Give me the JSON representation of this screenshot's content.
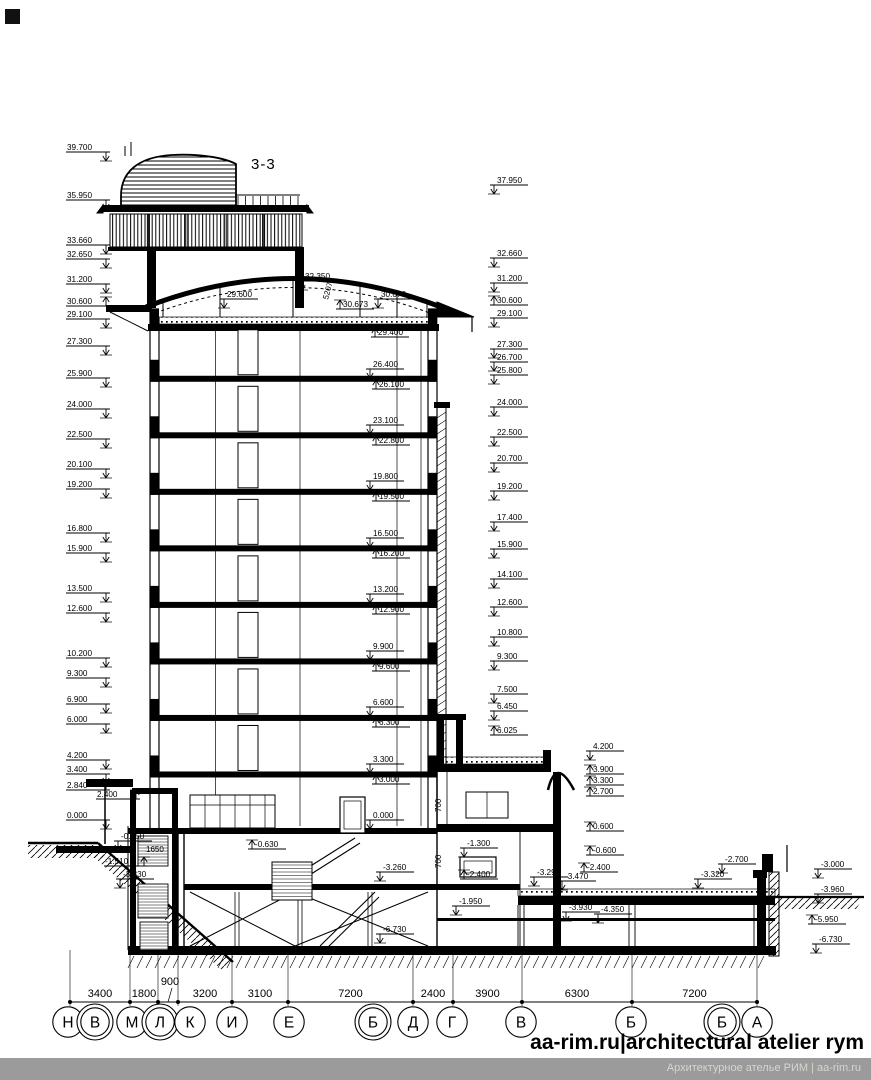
{
  "title": "3-3",
  "footer": {
    "brand": "aa-rim.ru|architectural atelier rym",
    "bar_text": "Архитектурное ателье РИМ | aa-rim.ru"
  },
  "colors": {
    "ink": "#000000",
    "footer_bar": "#9b9b9b",
    "footer_text": "#d8d5cf"
  },
  "levels": {
    "left": [
      {
        "v": "39.700",
        "y": 152,
        "d": "dn"
      },
      {
        "v": "35.950",
        "y": 200,
        "d": "dn"
      },
      {
        "v": "33.660",
        "y": 245,
        "d": "dn"
      },
      {
        "v": "32.650",
        "y": 259,
        "d": "dn"
      },
      {
        "v": "31.200",
        "y": 284,
        "d": "dn"
      },
      {
        "v": "30.600",
        "y": 306,
        "d": "up"
      },
      {
        "v": "29.100",
        "y": 319,
        "d": "dn"
      },
      {
        "v": "27.300",
        "y": 346,
        "d": "dn"
      },
      {
        "v": "25.900",
        "y": 378,
        "d": "dn"
      },
      {
        "v": "24.000",
        "y": 409,
        "d": "dn"
      },
      {
        "v": "22.500",
        "y": 439,
        "d": "dn"
      },
      {
        "v": "20.100",
        "y": 469,
        "d": "dn"
      },
      {
        "v": "19.200",
        "y": 489,
        "d": "dn"
      },
      {
        "v": "16.800",
        "y": 533,
        "d": "dn"
      },
      {
        "v": "15.900",
        "y": 553,
        "d": "dn"
      },
      {
        "v": "13.500",
        "y": 593,
        "d": "dn"
      },
      {
        "v": "12.600",
        "y": 613,
        "d": "dn"
      },
      {
        "v": "10.200",
        "y": 658,
        "d": "dn"
      },
      {
        "v": "9.300",
        "y": 678,
        "d": "dn"
      },
      {
        "v": "6.900",
        "y": 704,
        "d": "dn"
      },
      {
        "v": "6.000",
        "y": 724,
        "d": "dn"
      },
      {
        "v": "4.200",
        "y": 760,
        "d": "dn"
      },
      {
        "v": "3.400",
        "y": 774,
        "d": "dn"
      },
      {
        "v": "2.840",
        "y": 790,
        "d": "up"
      },
      {
        "v": "2.400",
        "y": 799,
        "d": "up",
        "x": 96
      },
      {
        "v": "0.000",
        "y": 820,
        "d": "dn"
      },
      {
        "v": "-1.510",
        "y": 866,
        "d": "up",
        "x": 104
      }
    ],
    "right": [
      {
        "v": "37.950",
        "y": 185,
        "d": "dn"
      },
      {
        "v": "32.660",
        "y": 258,
        "d": "dn"
      },
      {
        "v": "31.200",
        "y": 283,
        "d": "dn"
      },
      {
        "v": "30.600",
        "y": 305,
        "d": "up"
      },
      {
        "v": "29.100",
        "y": 318,
        "d": "dn"
      },
      {
        "v": "27.300",
        "y": 349,
        "d": "dn"
      },
      {
        "v": "26.700",
        "y": 362,
        "d": "dn"
      },
      {
        "v": "25.800",
        "y": 375,
        "d": "dn"
      },
      {
        "v": "24.000",
        "y": 407,
        "d": "dn"
      },
      {
        "v": "22.500",
        "y": 437,
        "d": "dn"
      },
      {
        "v": "20.700",
        "y": 463,
        "d": "dn"
      },
      {
        "v": "19.200",
        "y": 491,
        "d": "dn"
      },
      {
        "v": "17.400",
        "y": 522,
        "d": "dn"
      },
      {
        "v": "15.900",
        "y": 549,
        "d": "dn"
      },
      {
        "v": "14.100",
        "y": 579,
        "d": "dn"
      },
      {
        "v": "12.600",
        "y": 607,
        "d": "dn"
      },
      {
        "v": "10.800",
        "y": 637,
        "d": "dn"
      },
      {
        "v": "9.300",
        "y": 661,
        "d": "dn"
      },
      {
        "v": "7.500",
        "y": 694,
        "d": "dn"
      },
      {
        "v": "6.450",
        "y": 711,
        "d": "dn"
      },
      {
        "v": "6.025",
        "y": 735,
        "d": "up"
      },
      {
        "v": "4.200",
        "y": 751,
        "d": "dn",
        "x": 586
      },
      {
        "v": "3.900",
        "y": 774,
        "d": "up",
        "x": 586
      },
      {
        "v": "3.300",
        "y": 785,
        "d": "up",
        "x": 586
      },
      {
        "v": "2.700",
        "y": 796,
        "d": "up",
        "x": 586
      },
      {
        "v": "0.600",
        "y": 831,
        "d": "up",
        "x": 586
      },
      {
        "v": "-0.600",
        "y": 855,
        "d": "up",
        "x": 586
      }
    ],
    "center": [
      {
        "v": "32.350",
        "x": 298,
        "y": 281,
        "d": "dn"
      },
      {
        "v": "29.600",
        "x": 220,
        "y": 299,
        "d": "dn"
      },
      {
        "v": "30.673",
        "x": 336,
        "y": 309,
        "d": "up"
      },
      {
        "v": "30.070",
        "x": 374,
        "y": 299,
        "d": "dn"
      },
      {
        "v": "29.400",
        "x": 371,
        "y": 337,
        "d": "up"
      },
      {
        "v": "26.400",
        "x": 366,
        "y": 369,
        "d": "dn"
      },
      {
        "v": "26.100",
        "x": 372,
        "y": 389,
        "d": "up"
      },
      {
        "v": "23.100",
        "x": 366,
        "y": 425,
        "d": "dn"
      },
      {
        "v": "22.800",
        "x": 372,
        "y": 445,
        "d": "up"
      },
      {
        "v": "19.800",
        "x": 366,
        "y": 481,
        "d": "dn"
      },
      {
        "v": "19.500",
        "x": 372,
        "y": 501,
        "d": "up"
      },
      {
        "v": "16.500",
        "x": 366,
        "y": 538,
        "d": "dn"
      },
      {
        "v": "16.200",
        "x": 372,
        "y": 558,
        "d": "up"
      },
      {
        "v": "13.200",
        "x": 366,
        "y": 594,
        "d": "dn"
      },
      {
        "v": "12.900",
        "x": 372,
        "y": 614,
        "d": "up"
      },
      {
        "v": "9.900",
        "x": 366,
        "y": 651,
        "d": "dn"
      },
      {
        "v": "9.600",
        "x": 372,
        "y": 671,
        "d": "up"
      },
      {
        "v": "6.600",
        "x": 366,
        "y": 707,
        "d": "dn"
      },
      {
        "v": "6.300",
        "x": 372,
        "y": 727,
        "d": "up"
      },
      {
        "v": "3.300",
        "x": 366,
        "y": 764,
        "d": "dn"
      },
      {
        "v": "3.000",
        "x": 372,
        "y": 784,
        "d": "up"
      },
      {
        "v": "0.000",
        "x": 366,
        "y": 820,
        "d": "dn"
      }
    ]
  },
  "annotations": [
    {
      "t": "-0.950",
      "x": 114,
      "y": 841,
      "d": "dn"
    },
    {
      "t": "1650",
      "x": 146,
      "y": 852,
      "d": "no"
    },
    {
      "t": "-3.330",
      "x": 116,
      "y": 879,
      "d": "dn"
    },
    {
      "t": "-0.630",
      "x": 248,
      "y": 849,
      "d": "up"
    },
    {
      "t": "-3.260",
      "x": 376,
      "y": 872,
      "d": "dn"
    },
    {
      "t": "-6.730",
      "x": 376,
      "y": 934,
      "d": "dn"
    },
    {
      "t": "-1.300",
      "x": 460,
      "y": 848,
      "d": "dn"
    },
    {
      "t": "-2.400",
      "x": 460,
      "y": 879,
      "d": "up"
    },
    {
      "t": "-3.290",
      "x": 530,
      "y": 877,
      "d": "dn"
    },
    {
      "t": "-3.470",
      "x": 558,
      "y": 881,
      "d": "dn"
    },
    {
      "t": "-2.400",
      "x": 580,
      "y": 872,
      "d": "up"
    },
    {
      "t": "-1.950",
      "x": 452,
      "y": 906,
      "d": "dn"
    },
    {
      "t": "-3.930",
      "x": 562,
      "y": 912,
      "d": "dn"
    },
    {
      "t": "-4.350",
      "x": 594,
      "y": 914,
      "d": "dn"
    },
    {
      "t": "-3.320",
      "x": 694,
      "y": 879,
      "d": "dn"
    },
    {
      "t": "-2.700",
      "x": 718,
      "y": 864,
      "d": "dn"
    },
    {
      "t": "-3.000",
      "x": 814,
      "y": 869,
      "d": "dn"
    },
    {
      "t": "-3.960",
      "x": 814,
      "y": 894,
      "d": "dn"
    },
    {
      "t": "-5.950",
      "x": 808,
      "y": 924,
      "d": "up"
    },
    {
      "t": "-6.730",
      "x": 812,
      "y": 944,
      "d": "dn"
    },
    {
      "t": "5207",
      "x": 328,
      "y": 300,
      "d": "no",
      "rot": -75
    },
    {
      "t": "700",
      "x": 441,
      "y": 812,
      "d": "no",
      "rot": -90
    },
    {
      "t": "700",
      "x": 441,
      "y": 868,
      "d": "no",
      "rot": -90
    }
  ],
  "dimensions": {
    "items": [
      {
        "label": "3400",
        "x1": 70,
        "x2": 130
      },
      {
        "label": "1800",
        "x1": 130,
        "x2": 158
      },
      {
        "label": "900",
        "x1": 158,
        "x2": 178,
        "raised": true
      },
      {
        "label": "3200",
        "x1": 178,
        "x2": 232
      },
      {
        "label": "3100",
        "x1": 232,
        "x2": 288
      },
      {
        "label": "7200",
        "x1": 288,
        "x2": 413
      },
      {
        "label": "2400",
        "x1": 413,
        "x2": 453
      },
      {
        "label": "3900",
        "x1": 453,
        "x2": 522
      },
      {
        "label": "6300",
        "x1": 522,
        "x2": 632
      },
      {
        "label": "7200",
        "x1": 632,
        "x2": 757
      }
    ]
  },
  "axes": [
    {
      "label": "Н",
      "x": 68,
      "double": false
    },
    {
      "label": "В",
      "x": 95,
      "double": true
    },
    {
      "label": "М",
      "x": 132,
      "double": false
    },
    {
      "label": "Л",
      "x": 160,
      "double": true
    },
    {
      "label": "К",
      "x": 190,
      "double": false
    },
    {
      "label": "И",
      "x": 232,
      "double": false
    },
    {
      "label": "Е",
      "x": 289,
      "double": false
    },
    {
      "label": "Б",
      "x": 373,
      "double": true
    },
    {
      "label": "Д",
      "x": 413,
      "double": false
    },
    {
      "label": "Г",
      "x": 452,
      "double": false
    },
    {
      "label": "В",
      "x": 521,
      "double": false
    },
    {
      "label": "Б",
      "x": 631,
      "double": false
    },
    {
      "label": "Б",
      "x": 722,
      "double": true
    },
    {
      "label": "А",
      "x": 757,
      "double": false
    }
  ]
}
